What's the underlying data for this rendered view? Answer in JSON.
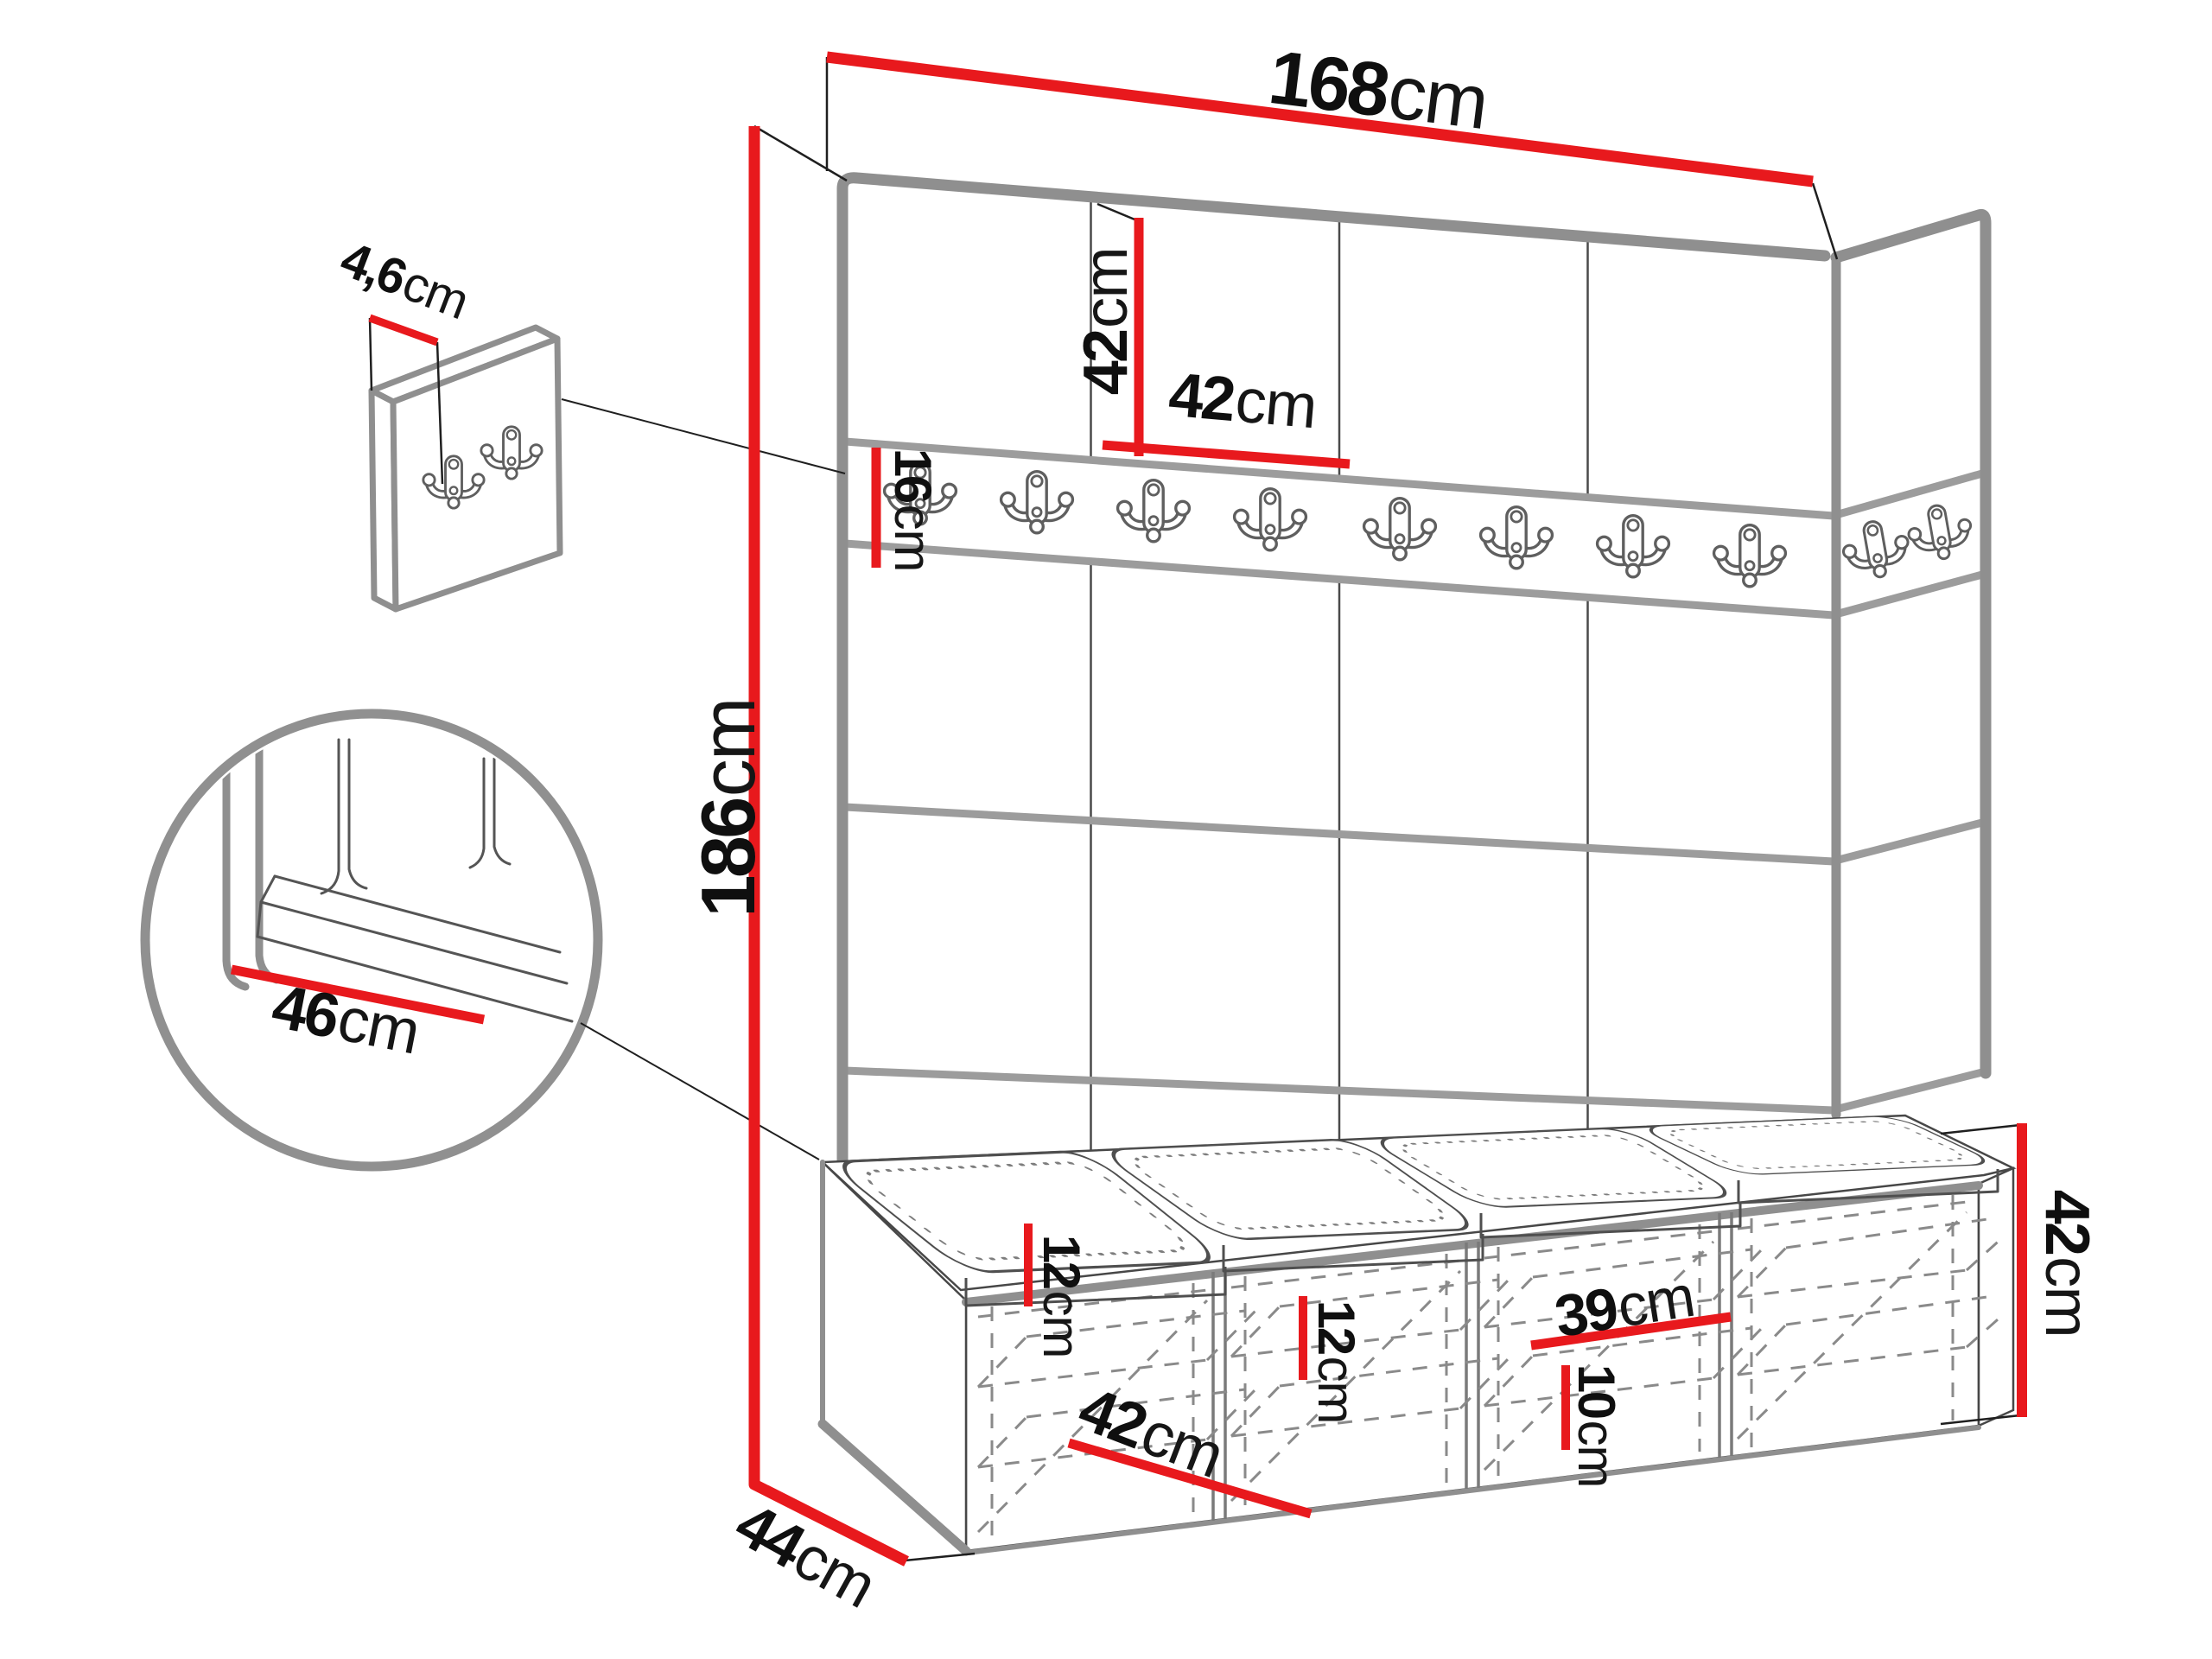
{
  "meta": {
    "type": "furniture-dimension-diagram",
    "subject": "hallway wardrobe set with padded wall panels, hook rail and shoe storage bench",
    "background": "#ffffff"
  },
  "colors": {
    "dimension_red": "#e8191d",
    "outline_gray": "#8f8f8f",
    "line_dark": "#474747",
    "dashed_gray": "#8a8a8a",
    "text": "#0f0f0f"
  },
  "dimensions": {
    "total_width": {
      "value": "168",
      "unit": "cm",
      "label": "168cm"
    },
    "top_panel_height": {
      "value": "42",
      "unit": "cm",
      "label": "42cm"
    },
    "panel_width": {
      "value": "42",
      "unit": "cm",
      "label": "42cm"
    },
    "hook_rail_height": {
      "value": "16",
      "unit": "cm",
      "label": "16cm"
    },
    "total_height": {
      "value": "186",
      "unit": "cm",
      "label": "186cm"
    },
    "hook_panel_thickness": {
      "value": "4,6",
      "unit": "cm",
      "label": "4,6cm"
    },
    "seat_depth": {
      "value": "46",
      "unit": "cm",
      "label": "46cm"
    },
    "shelf_spacing_left": {
      "value": "12",
      "unit": "cm",
      "label": "12cm"
    },
    "compartment_depth": {
      "value": "42",
      "unit": "cm",
      "label": "42cm"
    },
    "shelf_spacing_mid": {
      "value": "12",
      "unit": "cm",
      "label": "12cm"
    },
    "compartment_inner_width": {
      "value": "39",
      "unit": "cm",
      "label": "39cm"
    },
    "bottom_shelf_height": {
      "value": "10",
      "unit": "cm",
      "label": "10cm"
    },
    "bench_height": {
      "value": "42",
      "unit": "cm",
      "label": "42cm"
    },
    "unit_depth": {
      "value": "44",
      "unit": "cm",
      "label": "44cm"
    }
  },
  "scene": {
    "wall_panel_columns": 4,
    "wall_panel_rows": 3,
    "hook_rail_hook_count": 10,
    "detail_panel_hook_count": 2,
    "seat_cushion_count": 4,
    "storage_compartment_count": 4
  }
}
